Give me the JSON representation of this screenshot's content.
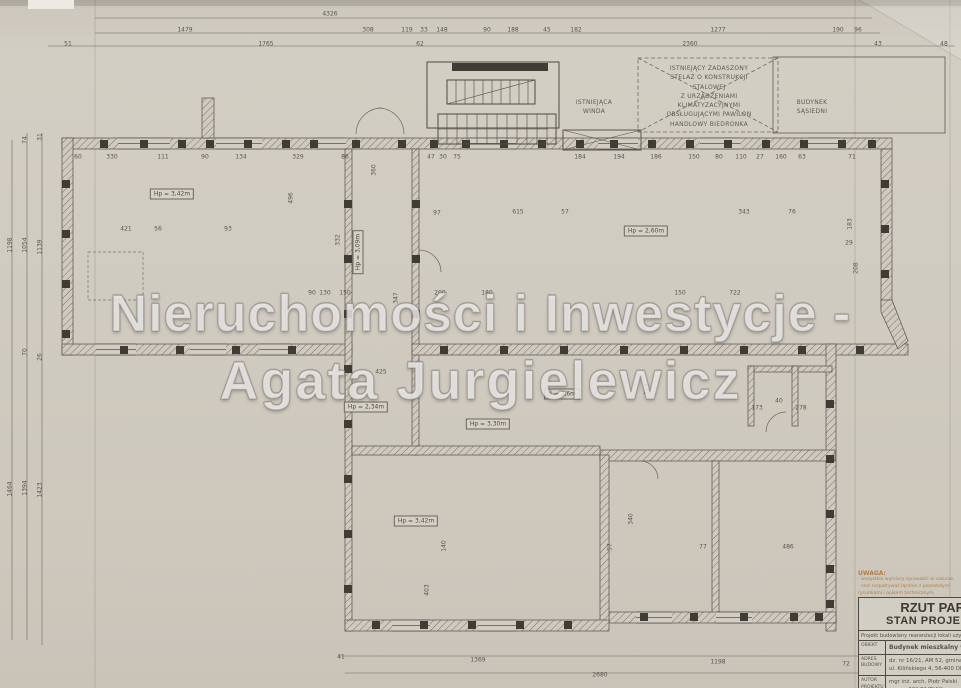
{
  "watermark": {
    "line1": "Nieruchomości i Inwestycje -",
    "line2": "Agata Jurgielewicz"
  },
  "annotations": {
    "canopy_note": [
      "ISTNIEJĄCY ZADASZONY",
      "STELAŻ O KONSTRUKCJI",
      "STALOWEJ",
      "Z URZĄDZENIAMI",
      "KLIMATYZACYJNYMI",
      "OBSŁUGUJĄCYMI PAWILON",
      "HANDLOWY BIEDRONKA"
    ],
    "neighbor_building": [
      "BUDYNEK",
      "SĄSIEDNI"
    ],
    "existing_elevator": [
      "ISTNIEJĄCA",
      "WINDA"
    ],
    "uwaga_heading": "UWAGA:",
    "uwaga_lines": [
      "- wszystkie wymiary sprawdzić w naturze,",
      "- rzut rozpatrywać łącznie z pozostałymi",
      "  rysunkami i opisem technicznym."
    ]
  },
  "title_block": {
    "title_line1": "RZUT PARTE",
    "title_line2": "STAN PROJEKTOW",
    "subtitle": "Projekt budowlany rearanżacji lokali użytkow",
    "rows": [
      {
        "label": "OBIEKT",
        "bold": true,
        "lines": [
          "Budynek mieszkalny wielo"
        ]
      },
      {
        "label": "ADRES BUDOWY",
        "bold": false,
        "lines": [
          "dz. nr 16/21, AM 52, gmina",
          "ul. Kilińskiego 4, 56-400 Ole"
        ]
      },
      {
        "label": "AUTOR PROJEKTU",
        "bold": false,
        "lines": [
          "mgr inż. arch. Piotr Palski",
          "upr. nr 301/01/DUW w sp. arch"
        ]
      },
      {
        "label": "AUTOR",
        "bold": false,
        "lines": [
          "mgr inż. Jacek Cieplacki"
        ]
      }
    ]
  },
  "room_labels": [
    [
      "Hp = 3,42m",
      172,
      194
    ],
    [
      "Hp = 3,09m",
      358,
      252,
      -90
    ],
    [
      "Hp = 2,60m",
      646,
      231
    ],
    [
      "Hp = 2,34m",
      366,
      407
    ],
    [
      "Hp = 3,30m",
      488,
      424
    ],
    [
      "Hp = 3,42m",
      416,
      521
    ],
    [
      "d = 2,6m",
      562,
      394
    ]
  ],
  "dimensions": [
    [
      "4326",
      330,
      14
    ],
    [
      "1479",
      185,
      30
    ],
    [
      "308",
      368,
      30
    ],
    [
      "119",
      407,
      30
    ],
    [
      "33",
      424,
      30
    ],
    [
      "148",
      442,
      30
    ],
    [
      "90",
      487,
      30
    ],
    [
      "188",
      513,
      30
    ],
    [
      "45",
      547,
      30
    ],
    [
      "182",
      576,
      30
    ],
    [
      "1277",
      718,
      30
    ],
    [
      "190",
      838,
      30
    ],
    [
      "96",
      858,
      30
    ],
    [
      "51",
      68,
      44
    ],
    [
      "1765",
      266,
      44
    ],
    [
      "62",
      420,
      44
    ],
    [
      "2360",
      690,
      44
    ],
    [
      "43",
      878,
      44
    ],
    [
      "48",
      944,
      44
    ],
    [
      "74",
      25,
      140,
      -90
    ],
    [
      "31",
      40,
      137,
      -90
    ],
    [
      "1198",
      10,
      245,
      -90
    ],
    [
      "1054",
      25,
      245,
      -90
    ],
    [
      "1139",
      40,
      247,
      -90
    ],
    [
      "70",
      25,
      352,
      -90
    ],
    [
      "26",
      40,
      357,
      -90
    ],
    [
      "1464",
      10,
      489,
      -90
    ],
    [
      "1394",
      25,
      488,
      -90
    ],
    [
      "1423",
      40,
      490,
      -90
    ],
    [
      "41",
      341,
      657
    ],
    [
      "1369",
      478,
      660
    ],
    [
      "1198",
      718,
      662
    ],
    [
      "72",
      846,
      664
    ],
    [
      "2680",
      600,
      675
    ],
    [
      "60",
      78,
      157
    ],
    [
      "330",
      112,
      157
    ],
    [
      "111",
      163,
      157
    ],
    [
      "90",
      205,
      157
    ],
    [
      "134",
      241,
      157
    ],
    [
      "329",
      298,
      157
    ],
    [
      "86",
      345,
      157
    ],
    [
      "360",
      374,
      170,
      -90
    ],
    [
      "47",
      431,
      157
    ],
    [
      "30",
      443,
      157
    ],
    [
      "75",
      457,
      157
    ],
    [
      "184",
      580,
      157
    ],
    [
      "194",
      619,
      157
    ],
    [
      "186",
      656,
      157
    ],
    [
      "150",
      694,
      157
    ],
    [
      "80",
      719,
      157
    ],
    [
      "110",
      741,
      157
    ],
    [
      "27",
      760,
      157
    ],
    [
      "160",
      781,
      157
    ],
    [
      "63",
      802,
      157
    ],
    [
      "71",
      852,
      157
    ],
    [
      "421",
      126,
      229
    ],
    [
      "56",
      158,
      229
    ],
    [
      "93",
      228,
      229
    ],
    [
      "496",
      291,
      198,
      -90
    ],
    [
      "332",
      338,
      240,
      -90
    ],
    [
      "347",
      396,
      298,
      -90
    ],
    [
      "97",
      437,
      213
    ],
    [
      "615",
      518,
      212
    ],
    [
      "57",
      565,
      212
    ],
    [
      "343",
      744,
      212
    ],
    [
      "76",
      792,
      212
    ],
    [
      "183",
      850,
      224,
      -90
    ],
    [
      "29",
      849,
      243
    ],
    [
      "208",
      856,
      268,
      -90
    ],
    [
      "90",
      312,
      293
    ],
    [
      "130",
      325,
      293
    ],
    [
      "150",
      345,
      293
    ],
    [
      "200",
      440,
      293
    ],
    [
      "180",
      487,
      293
    ],
    [
      "150",
      680,
      293
    ],
    [
      "722",
      735,
      293
    ],
    [
      "425",
      381,
      372
    ],
    [
      "515",
      647,
      389,
      -90
    ],
    [
      "173",
      757,
      408
    ],
    [
      "40",
      779,
      401
    ],
    [
      "278",
      801,
      408
    ],
    [
      "340",
      631,
      519,
      -90
    ],
    [
      "140",
      444,
      546,
      -90
    ],
    [
      "403",
      427,
      590,
      -90
    ],
    [
      "57",
      610,
      547,
      -90
    ],
    [
      "77",
      703,
      547
    ],
    [
      "486",
      788,
      547
    ]
  ],
  "colors": {
    "paper": "#d0cbc0",
    "ink": "#55514a",
    "wall_dark": "#3f3c35",
    "note_orange": "#b08049",
    "watermark": "rgba(255,255,255,0.72)"
  }
}
